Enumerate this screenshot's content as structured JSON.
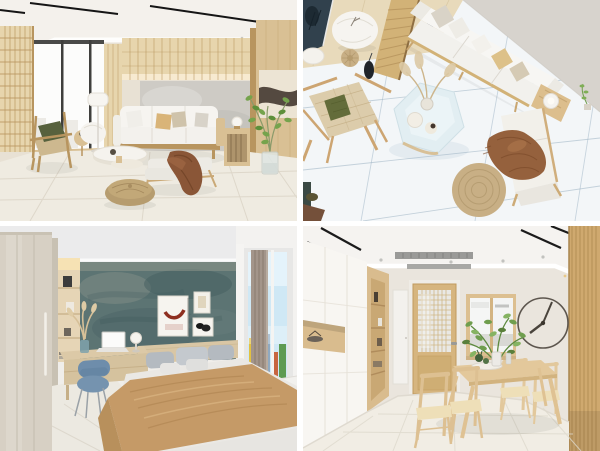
{
  "collage": {
    "grid": "2x2",
    "panels": [
      {
        "id": "living-room-perspective",
        "label": "Japandi living room, perspective view",
        "position": "top-left"
      },
      {
        "id": "living-room-overhead",
        "label": "Japandi living room, overhead view",
        "position": "top-right"
      },
      {
        "id": "bedroom-teal-wall",
        "label": "Bedroom with teal accent wall and bay window",
        "position": "bottom-left"
      },
      {
        "id": "dining-room",
        "label": "Dining room with wooden table and wall clock",
        "position": "bottom-right"
      }
    ]
  },
  "palette": {
    "ui": {
      "gutter": "#ffffff"
    },
    "p1": {
      "wall": "#e8e1d4",
      "ceiling": "#f4f1ec",
      "track": "#151515",
      "vent": "#77756f",
      "lattice": "#e7d5ad",
      "wood": "#d9c094",
      "wood-dark": "#b8955f",
      "glow": "#f7ead0",
      "accent": "#cecbc5",
      "window": "#fcfcfb",
      "mullion": "#3f3f3d",
      "floor": "#efebe1",
      "grout": "#dbd5c8",
      "sofa": "#f3f1ed",
      "sofa-light": "#f6f4f0",
      "pillow-tan": "#d9b478",
      "pillow-beige": "#cfc3ab",
      "green": "#57613d",
      "weave": "#cdb88f",
      "brown": "#8a5637",
      "brown-dark": "#6f4226",
      "pouf": "#b69c6f",
      "art-dark": "#473c33",
      "plant": "#75a34c",
      "plant-dark": "#5d8f3a",
      "glass": "#dfe6e3",
      "lamp": "#f7f5f1"
    },
    "p2": {
      "floor": "#f3f6f8",
      "grout": "#93abbe",
      "wall": "#d7d3cd",
      "wood-floor": "#e8dabb",
      "screen": "#d2b277",
      "screen-line": "#b8965e",
      "sofa": "#f2f1ed",
      "sofa-light": "#f7f6f3",
      "pillow-gray": "#d9d3c7",
      "pillow-tan": "#ddc189",
      "pillow-beige": "#d5cab4",
      "table": "#e2eef2",
      "table-edge": "#cfe0e6",
      "plume": "#dcc9a4",
      "pampas": "#cdb58b",
      "olive": "#636c3a",
      "weave": "#dcccab",
      "wood": "#dcbe8d",
      "wood-line": "#c2a16e",
      "brown": "#95613d",
      "brown-dark": "#7c4a2a",
      "jute": "#c8af85",
      "jute-line": "#b39a6f",
      "window-dark": "#31414d",
      "black": "#20242a",
      "corner-dark": "#3c4a44",
      "corner-wood": "#74503a"
    },
    "p3": {
      "ceiling": "#ebebec",
      "wall": "#f0eeea",
      "wardrobe": "#d7d0c4",
      "wardrobe-line": "#c3bcae",
      "niche": "#e6d5b6",
      "niche-glow": "#f6e2b4",
      "teal": "#5c7473",
      "teal-dark": "#435d60",
      "teal-light": "#8b968c",
      "frame": "#f6f4ef",
      "art-red": "#8e2f20",
      "art-pink": "#e3cdc5",
      "headboard": "#d9c6a4",
      "pillow-a": "#b4bac0",
      "pillow-b": "#c4c9ce",
      "bed": "#eae8e4",
      "blanket": "#c59a67",
      "blanket-dark": "#ad8350",
      "blanket-light": "#dab583",
      "desk": "#dcc9a7",
      "desk-front": "#d5c29e",
      "chair": "#6e8dab",
      "chair-dark": "#5d7e9c",
      "leg-gray": "#9aa1a7",
      "sky": "#cfe8f5",
      "curtain": "#a3958a",
      "curtain-line": "#8c7e71",
      "city-a": "#e2c140",
      "city-b": "#d9b13c",
      "city-c": "#8fa9c0",
      "city-d": "#c7653f",
      "city-e": "#5e9b52",
      "window-frame": "#f3f2f0",
      "seat": "#f2f1ee",
      "floor": "#ece9e1",
      "floor-line": "#dbd6cb",
      "lamp": "#f6f4ef"
    },
    "p4": {
      "ceiling": "#f5f3f0",
      "wall": "#eae5dd",
      "vent": "#9a9a98",
      "track": "#1b1b1b",
      "slat": "#cfa96f",
      "slat-line": "#b8935b",
      "cabinet": "#f8f6f2",
      "cabinet-line": "#e6e1d8",
      "wood": "#d9bc8e",
      "wood-inner": "#c9a874",
      "wood-line": "#b08c5c",
      "hall-door": "#f3f1ed",
      "door": "#d6b57f",
      "door-stroke": "#c09a5f",
      "door-lower": "#cfae74",
      "glass": "#e9e8e4",
      "glass-grid": "#cdb27e",
      "handle": "#9a9a97",
      "window-wood": "#dcbf90",
      "pane": "#f5f6f5",
      "clock": "#5d564e",
      "hand": "#4a443c",
      "table": "#e3c89b",
      "table-edge": "#d2b37f",
      "leg": "#dfc293",
      "chair-wood": "#ddc092",
      "chair-wood2": "#e2c89c",
      "cushion": "#eedfb8",
      "plant": "#6f9e4e",
      "plant-light": "#85b362",
      "plant-dark": "#597f3a",
      "stem": "#5d8a3f",
      "vase": "#eceae6",
      "floor": "#f1ede4",
      "grout": "#ddd8cc"
    }
  }
}
